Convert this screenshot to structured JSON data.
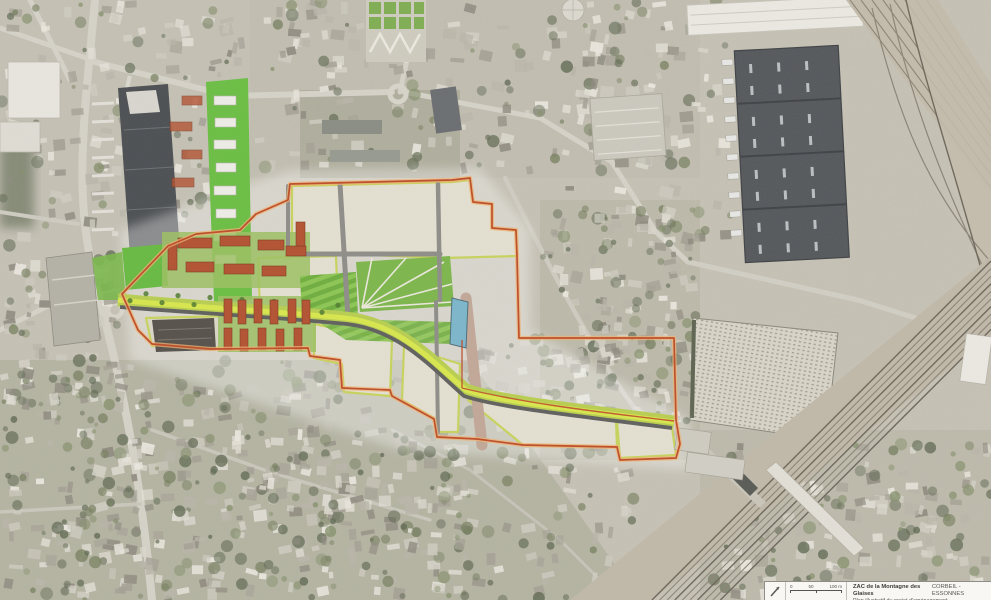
{
  "legend": {
    "title": "ZAC de la Montagne des Glaises",
    "city": "CORBEIL - ESSONNES",
    "subtitle": "Plan illustratif du projet d'aménagement",
    "scale_labels": [
      "0",
      "50",
      "100 m"
    ],
    "north_arrow_icon": "north-arrow"
  },
  "map": {
    "kind": "aerial masterplan overlay",
    "colors": {
      "zac_boundary": "#bf4b28",
      "boundary_halo": "#f0b473",
      "parcel_fill": "#e5e1d2",
      "parcel_edge": "#c8d45c",
      "boulevard_green": "#b9cf4f",
      "boulevard_core": "#d9e84c",
      "lawn_green": "#74b244",
      "water_basin": "#7cb6cc",
      "housing_roof": "#b35130",
      "warehouse_roof": "#54575b",
      "railway_bed": "#c1b9a9",
      "aerial_base": "#c6c2b5"
    }
  }
}
